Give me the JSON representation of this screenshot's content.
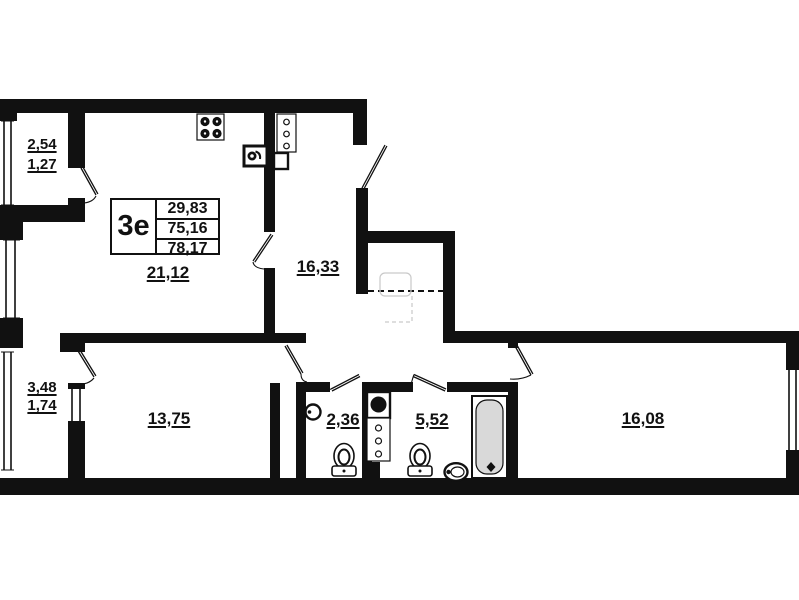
{
  "plan": {
    "title": "apartment floor plan",
    "table": {
      "type_label": "3е",
      "values": [
        "29,83",
        "75,16",
        "78,17"
      ]
    },
    "rooms": [
      {
        "id": "kitchen-living",
        "area": "21,12"
      },
      {
        "id": "hallway",
        "area": "16,33"
      },
      {
        "id": "bedroom-left",
        "area": "13,75"
      },
      {
        "id": "wc",
        "area": "2,36"
      },
      {
        "id": "bathroom",
        "area": "5,52"
      },
      {
        "id": "bedroom-right",
        "area": "16,08"
      }
    ],
    "balconies": [
      {
        "id": "balcony-top-left",
        "full_area": "2,54",
        "reduced_area": "1,27"
      },
      {
        "id": "balcony-mid-left",
        "full_area": "3,48",
        "reduced_area": "1,74"
      }
    ],
    "icons": [
      "stove-icon",
      "kitchen-sink-icon",
      "vent-box-icon",
      "duct-column-icon",
      "shaft-sink-icon",
      "shaft-column-icon",
      "toilet-icon",
      "toilet-icon",
      "round-sink-icon",
      "oval-sink-icon",
      "bathtub-icon"
    ],
    "colors": {
      "wall": "#111111",
      "background": "#ffffff",
      "tub_fill": "#d9d9d9",
      "ghost": "#c9c9c9"
    }
  }
}
